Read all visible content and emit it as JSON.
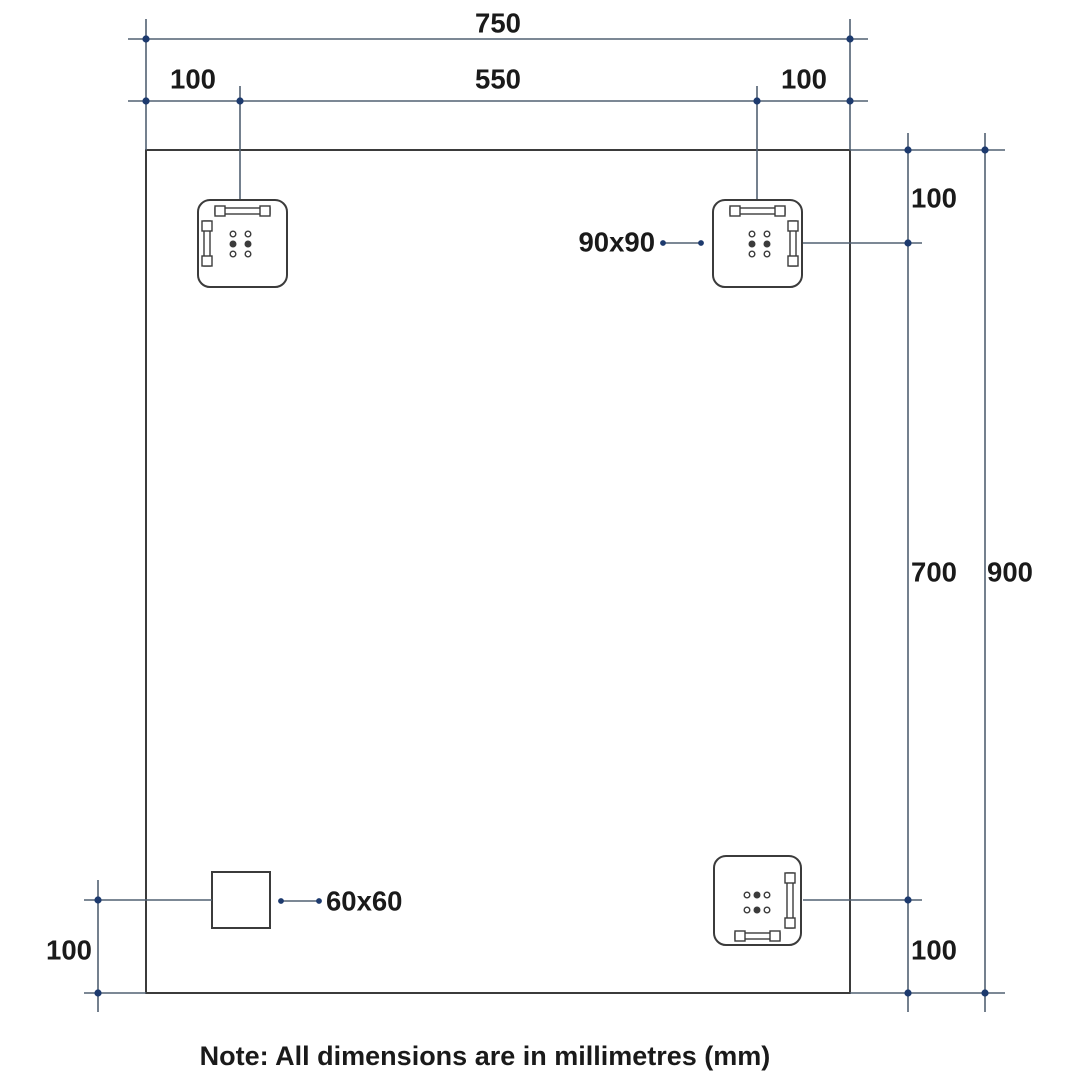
{
  "drawing": {
    "dims": {
      "overall_width": "750",
      "top_left_offset": "100",
      "top_center_span": "550",
      "top_right_offset": "100",
      "right_top_offset": "100",
      "right_mid_span": "700",
      "overall_height": "900",
      "right_bottom_offset": "100",
      "left_bottom_offset": "100"
    },
    "callouts": {
      "bracket_size": "90x90",
      "square_size": "60x60"
    },
    "note": "Note: All dimensions are in millimetres (mm)",
    "colors": {
      "background": "#ffffff",
      "object_line": "#3b3b3b",
      "dimension_line": "#516072",
      "node_dot": "#1d3a6e",
      "text": "#1a1a1a"
    }
  }
}
